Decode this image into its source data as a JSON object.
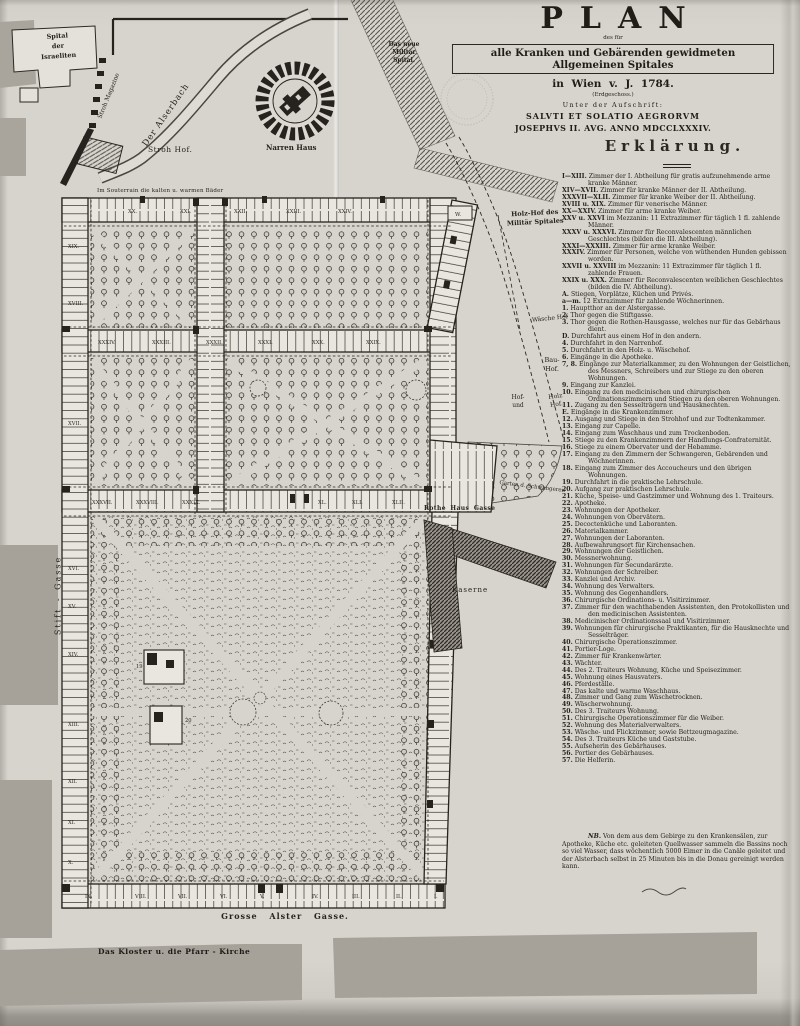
{
  "colors": {
    "paper": "#d7d4cd",
    "ink": "#2b2823",
    "wing_fill": "#e9e6df",
    "city_gray": "#a6a29a",
    "stamp": "#b8b4aa"
  },
  "title_block": {
    "title": "PLAN",
    "subtitle_small": "des für",
    "subtitle_boxed": "alle Kranken und Gebärenden gewidmeten Allgemeinen Spitales",
    "subtitle_line2": "in Wien v. J. 1784.",
    "floor_note": "(Erdgeschoss.)",
    "inscription_intro": "Unter der Aufschrift:",
    "inscription_line1": "SALVTI ET SOLATIO AEGRORVM",
    "inscription_line2": "JOSEPHVS II. AVG. ANNO MDCCLXXXIV."
  },
  "legend": {
    "heading": "Erklärung.",
    "entries": [
      {
        "key": "I—XIII.",
        "text": "Zimmer der I. Abtheilung für gratis aufzunehmende arme kranke Männer."
      },
      {
        "key": "XIV—XVII.",
        "text": "Zimmer für kranke Männer der II. Abtheilung."
      },
      {
        "key": "XXXVII—XLII.",
        "text": "Zimmer für kranke Weiber der II. Abtheilung."
      },
      {
        "key": "XVIII u. XIX.",
        "text": "Zimmer für venerische Männer."
      },
      {
        "key": "XX—XXIV.",
        "text": "Zimmer für arme kranke Weiber."
      },
      {
        "key": "XXV u. XXVI",
        "text": "im Mezzanin: 11 Extrazimmer für täglich 1 fl. zahlende Männer."
      },
      {
        "key": "XXXV u. XXXVI.",
        "text": "Zimmer für Reconvalescenten männlichen Geschlechtes (bilden die III. Abtheilung)."
      },
      {
        "key": "XXXI—XXXIII.",
        "text": "Zimmer für arme kranke Weiber."
      },
      {
        "key": "XXXIV.",
        "text": "Zimmer für Personen, welche von wüthenden Hunden gebissen worden."
      },
      {
        "key": "XXVII u. XXVIII",
        "text": "im Mezzanin: 11 Extrazimmer für täglich 1 fl. zahlende Frauen."
      },
      {
        "key": "XXIX u. XXX.",
        "text": "Zimmer für Reconvalescenten weiblichen Geschlechtes (bilden die IV. Abtheilung)."
      },
      {
        "key": "A.",
        "text": "Stiegen, Vorplätze, Küchen und Privés."
      },
      {
        "key": "a—m.",
        "text": "12 Extrazimmer für zahlende Wöchnerinnen."
      },
      {
        "key": "1.",
        "text": "Hauptthor an der Alstergasse."
      },
      {
        "key": "2.",
        "text": "Thor gegen die Stiftgasse."
      },
      {
        "key": "3.",
        "text": "Thor gegen die Rothen-Hausgasse, welches nur für das Gebärhaus dient."
      },
      {
        "key": "D.",
        "text": "Durchfahrt aus einem Hof in den andern."
      },
      {
        "key": "4.",
        "text": "Durchfahrt in den Narrenhof."
      },
      {
        "key": "5.",
        "text": "Durchfahrt in den Holz- u. Wäschehof."
      },
      {
        "key": "6.",
        "text": "Eingänge in die Apotheke."
      },
      {
        "key": "7, 8.",
        "text": "Eingänge zur Materialkammer, zu den Wohnungen der Geistlichen, des Messners, Schreibers und zur Stiege zu den oberen Wohnungen."
      },
      {
        "key": "9.",
        "text": "Eingang zur Kanzlei."
      },
      {
        "key": "10.",
        "text": "Eingang zu den medicinischen und chirurgischen Ordinationszimmern und Stiegen zu den oberen Wohnungen."
      },
      {
        "key": "11.",
        "text": "Zugang zu den Sesselträgern und Hausknechten."
      },
      {
        "key": "E.",
        "text": "Eingänge in die Krankenzimmer."
      },
      {
        "key": "12.",
        "text": "Ausgang und Stiege in den Strohhof und zur Todtenkammer."
      },
      {
        "key": "13.",
        "text": "Eingang zur Capelle."
      },
      {
        "key": "14.",
        "text": "Eingang zum Waschhaus und zum Trockenboden."
      },
      {
        "key": "15.",
        "text": "Stiege zu den Krankenzimmern der Handlungs-Confraternität."
      },
      {
        "key": "16.",
        "text": "Stiege zu einem Obervater und der Hebamme."
      },
      {
        "key": "17.",
        "text": "Eingang zu den Zimmern der Schwangeren, Gebärenden und Wöchnerinnen."
      },
      {
        "key": "18.",
        "text": "Eingang zum Zimmer des Accoucheurs und den übrigen Wohnungen."
      },
      {
        "key": "19.",
        "text": "Durchfahrt in die praktische Lehrschule."
      },
      {
        "key": "20.",
        "text": "Aufgang zur praktischen Lehrschule."
      },
      {
        "key": "21.",
        "text": "Küche, Speise- und Gastzimmer und Wohnung des 1. Traiteurs."
      },
      {
        "key": "22.",
        "text": "Apotheke."
      },
      {
        "key": "23.",
        "text": "Wohnungen der Apotheker."
      },
      {
        "key": "24.",
        "text": "Wohnungen von Obervätern."
      },
      {
        "key": "25.",
        "text": "Decoctenküche und Laboranten."
      },
      {
        "key": "26.",
        "text": "Materialkammer."
      },
      {
        "key": "27.",
        "text": "Wohnungen der Laboranten."
      },
      {
        "key": "28.",
        "text": "Aufbewahrungsort für Kirchensachen."
      },
      {
        "key": "29.",
        "text": "Wohnungen der Geistlichen."
      },
      {
        "key": "30.",
        "text": "Messnerwohnung."
      },
      {
        "key": "31.",
        "text": "Wohnungen für Secundarärzte."
      },
      {
        "key": "32.",
        "text": "Wohnungen der Schreiber."
      },
      {
        "key": "33.",
        "text": "Kanzlei und Archiv."
      },
      {
        "key": "34.",
        "text": "Wohnung des Verwalters."
      },
      {
        "key": "35.",
        "text": "Wohnung des Gegenhandlers."
      },
      {
        "key": "36.",
        "text": "Chirurgische Ordinations- u. Visitirzimmer."
      },
      {
        "key": "37.",
        "text": "Zimmer für den wachthabenden Assistenten, den Protokollisten und den medicinischen Assistenten."
      },
      {
        "key": "38.",
        "text": "Medicinischer Ordinationssaal und Visitirzimmer."
      },
      {
        "key": "39.",
        "text": "Wohnungen für chirurgische Praktikanten, für die Hausknechte und Sesselträger."
      },
      {
        "key": "40.",
        "text": "Chirurgische Operationszimmer."
      },
      {
        "key": "41.",
        "text": "Portier-Loge."
      },
      {
        "key": "42.",
        "text": "Zimmer für Krankenwärter."
      },
      {
        "key": "43.",
        "text": "Wächter."
      },
      {
        "key": "44.",
        "text": "Des 2. Traiteurs Wohnung, Küche und Speisezimmer."
      },
      {
        "key": "45.",
        "text": "Wohnung eines Hausvaters."
      },
      {
        "key": "46.",
        "text": "Pferdeställe."
      },
      {
        "key": "47.",
        "text": "Das kalte und warme Waschhaus."
      },
      {
        "key": "48.",
        "text": "Zimmer und Gang zum Wäschetrocknen."
      },
      {
        "key": "49.",
        "text": "Wäscherwohnung."
      },
      {
        "key": "50.",
        "text": "Des 3. Traiteurs Wohnung."
      },
      {
        "key": "51.",
        "text": "Chirurgische Operationszimmer für die Weiber."
      },
      {
        "key": "52.",
        "text": "Wohnung des Materialverwalters."
      },
      {
        "key": "53.",
        "text": "Wäsche- und Flickzimmer, sowie Bettzeugmagazine."
      },
      {
        "key": "54.",
        "text": "Des 3. Traiteurs Küche und Gaststube."
      },
      {
        "key": "55.",
        "text": "Aufseherin des Gebärhauses."
      },
      {
        "key": "56.",
        "text": "Portier des Gebärhauses."
      },
      {
        "key": "57.",
        "text": "Die Helferin."
      }
    ],
    "nb_label": "NB.",
    "nb_text": "Von dem aus dem Gebirge zu den Krankensälen, zur Apotheke, Küche etc. geleiteten Quellwasser sammeln die Bassins noch so viel Wasser, dass wöchentlich 5000 Eimer in die Canäle geleitet und der Alsterbach selbst in 25 Minuten bis in die Donau gereinigt werden kann."
  },
  "map_labels": {
    "spital_israeliten": "Spital\nder\nIsraeliten",
    "der_alserbach": "Der Alserbach",
    "stroh_magazine": "Stroh Magazine",
    "stroh_hof": "Stroh Hof.",
    "narren_haus": "Narren Haus",
    "militaer_spital": "Das neue\nMilitär\nSpital.",
    "souterrain_note": "Im Souterrain die kalten u. warmen Bäder",
    "holz_hof_militaer": "Holz-Hof des\nMilitär Spitales",
    "waesche_hof": "Wäsche Hof",
    "bau_hof": "Bau-\nHof.",
    "hof_und": "Hof-\nund",
    "holz_hof": "Holz\nHof.",
    "garten_schwangeren": "Garten d. Schwangeren",
    "rothe_haus_gasse": "Rothe Haus Gasse",
    "kaserne": "Kaserne",
    "stift_gasse": "Stift - Gasse",
    "grosse_alster_gasse": "Grosse Alster Gasse.",
    "kloster": "Das Kloster u. die Pfarr - Kirche",
    "w_building": "W."
  },
  "rooms": {
    "top_wing": [
      "XX.",
      "XXI.",
      "XXII.",
      "XXIII.",
      "XXIV."
    ],
    "middle_wing": [
      "XXXIV.",
      "XXXIII.",
      "XXXII.",
      "XXXI.",
      "XXX.",
      "XXIX."
    ],
    "third_wing": [
      "XXXVII.",
      "XXXVIII.",
      "XXXIX.",
      "XL.",
      "XLI.",
      "XLII."
    ],
    "bottom_wing": [
      "IX.",
      "VIII.",
      "VII.",
      "VI.",
      "V.",
      "IV.",
      "III.",
      "II.",
      "I."
    ],
    "west_wing": [
      "XIX.",
      "XVIII.",
      "XVII.",
      "XVI.",
      "XV.",
      "XIV.",
      "XIII.",
      "XII.",
      "XI.",
      "X."
    ],
    "garden_buildings": [
      "19",
      "20"
    ]
  },
  "imprint": "···· · ·· ····· ····· ··········· ···· ··"
}
